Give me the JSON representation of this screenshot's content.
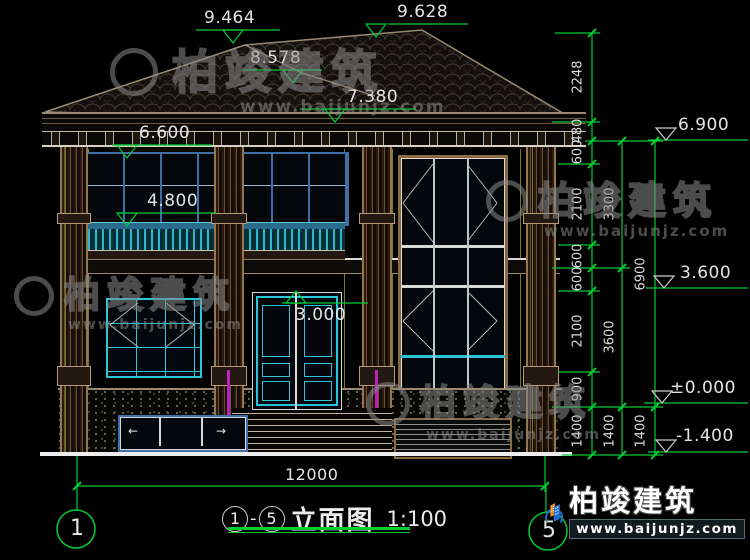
{
  "title": {
    "axis_from": "1",
    "dash": "-",
    "axis_to": "5",
    "name": "立面图",
    "scale": "1:100"
  },
  "axis_bubbles": {
    "left": "1",
    "right": "5"
  },
  "elevations_top": [
    "9.464",
    "9.628",
    "8.578",
    "7.380",
    "6.600",
    "4.800",
    "3.000"
  ],
  "elevations_right": [
    "6.900",
    "3.600",
    "±0.000",
    "-1.400"
  ],
  "chains": {
    "inner": [
      "2248",
      "480",
      "600",
      "2100",
      "600",
      "600",
      "2100",
      "900",
      "1400"
    ],
    "middle": [
      "3300",
      "3600",
      "1400"
    ],
    "outer": [
      "6900",
      "1400"
    ]
  },
  "bottom_dim": "12000",
  "glyphs": {
    "arrow_left": "←",
    "arrow_right": "→"
  },
  "watermark": {
    "brand": "柏竣建筑",
    "site": "www.baijunjz.com"
  },
  "brand_logo": {
    "brand": "柏竣建筑",
    "site": "www.baijunjz.com"
  },
  "colors": {
    "dim_green": "#00cc33",
    "cad_white": "#e4e4e4",
    "frame_blue": "#3f6fa8",
    "accent_cyan": "#2cc4d8",
    "column_brown": "#96764e",
    "magenta": "#c020c0",
    "logo_blue": "#1f6fd0",
    "logo_orange": "#f08a1d"
  }
}
